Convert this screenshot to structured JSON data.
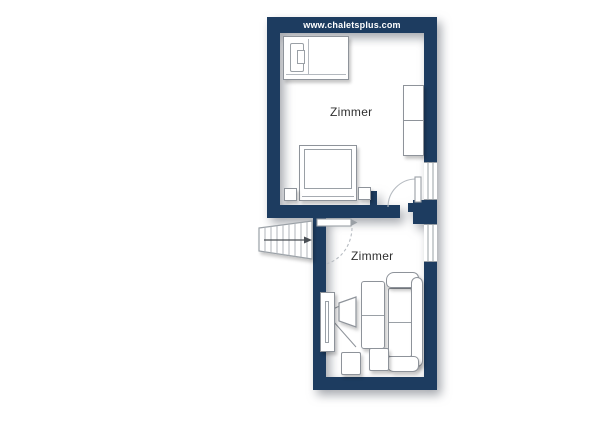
{
  "watermark": {
    "text": "www.chaletsplus.com"
  },
  "rooms": {
    "upper": {
      "label": "Zimmer"
    },
    "lower": {
      "label": "Zimmer"
    }
  },
  "colors": {
    "wall": "#1d3c60",
    "furniture_outline": "#8e939a",
    "label_text": "#2f2f2f",
    "watermark_text": "#ffffff",
    "background": "#ffffff"
  },
  "symbols": {
    "staircase": "tapered-steps-with-direction-arrow",
    "door": "quarter-circle-swing-arc-with-leaf",
    "window": "double-line-in-wall",
    "wardrobe": "rect-with-x-cells",
    "single-bed": "rect-with-pillow",
    "double-bed": "rect-with-duvet-and-nightstands",
    "tv": "trapezoid-screen-with-projection-lines",
    "sofa": "rect-with-armrests-and-backrest",
    "stool": "small-square",
    "table": "divided-rect"
  }
}
